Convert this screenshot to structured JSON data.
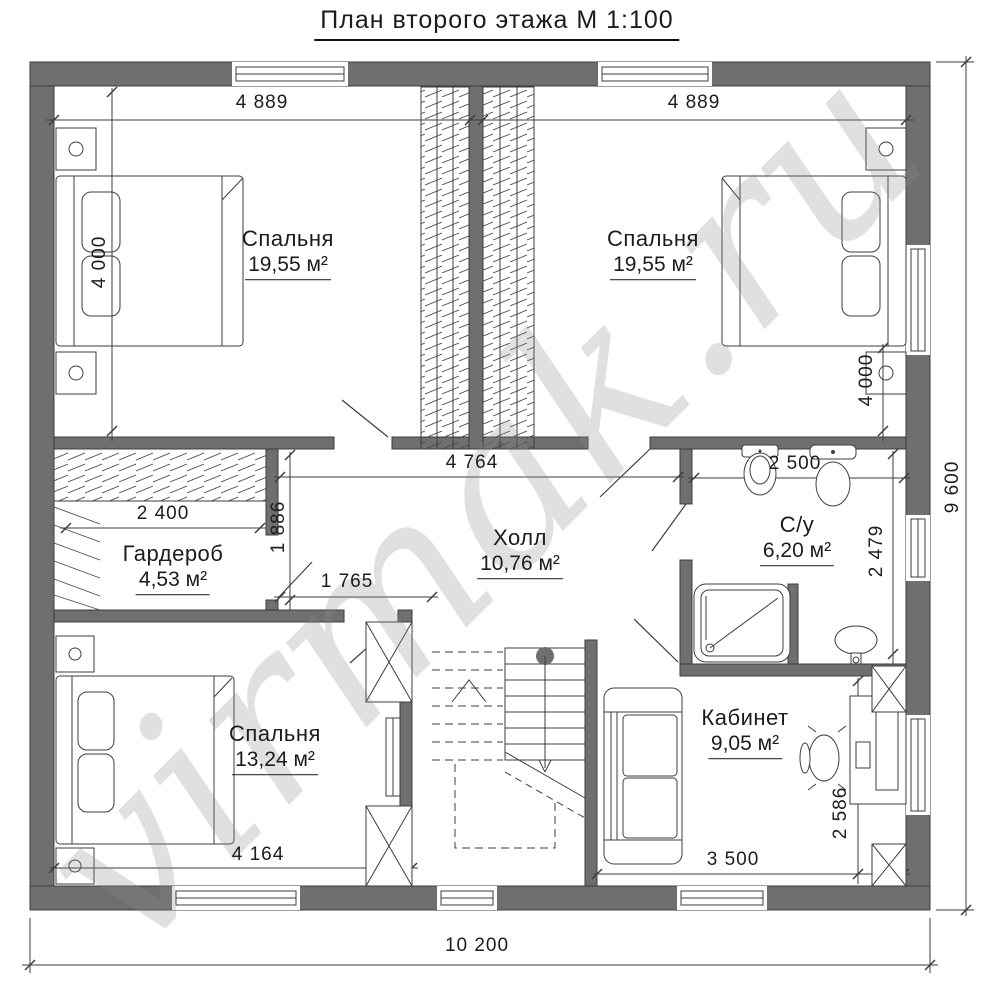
{
  "title": "План второго этажа М 1:100",
  "watermark": "virmak.ru",
  "area_unit": "м²",
  "rooms": [
    {
      "id": "bedroom-1",
      "name": "Спальня",
      "area": "19,55"
    },
    {
      "id": "bedroom-2",
      "name": "Спальня",
      "area": "19,55"
    },
    {
      "id": "wardrobe",
      "name": "Гардероб",
      "area": "4,53"
    },
    {
      "id": "hall",
      "name": "Холл",
      "area": "10,76"
    },
    {
      "id": "bathroom",
      "name": "С/у",
      "area": "6,20"
    },
    {
      "id": "bedroom-3",
      "name": "Спальня",
      "area": "13,24"
    },
    {
      "id": "office",
      "name": "Кабинет",
      "area": "9,05"
    }
  ],
  "dimensions": {
    "top_left_width": "4 889",
    "top_right_width": "4 889",
    "bedroom1_depth": "4 000",
    "bedroom2_depth": "4 000",
    "wardrobe_width": "2 400",
    "wardrobe_depth": "1 886",
    "hall_width": "4 764",
    "hall_passage": "1 765",
    "bathroom_width": "2 500",
    "bathroom_depth": "2 479",
    "bedroom3_width": "4 164",
    "office_width": "3 500",
    "office_depth": "2 586",
    "total_width": "10 200",
    "total_depth": "9 600"
  },
  "colors": {
    "wall": "#6f6f6f",
    "line": "#3d3d3d",
    "text": "#1c1c1c",
    "watermark": "#dcdcdc"
  }
}
